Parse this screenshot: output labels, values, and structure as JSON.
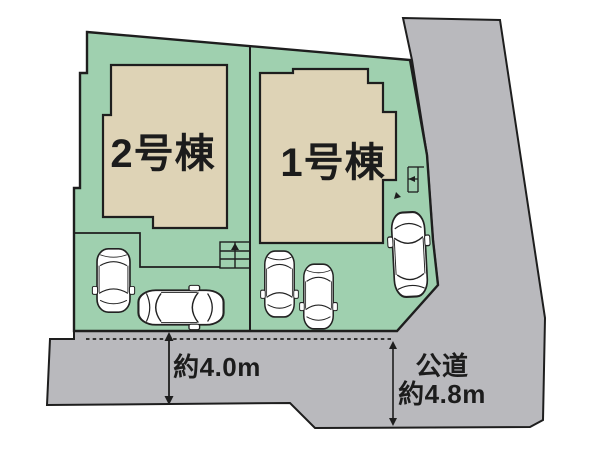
{
  "site_plan": {
    "type": "real-estate-lot-layout",
    "buildings": [
      {
        "label": "2号棟"
      },
      {
        "label": "1号棟"
      }
    ],
    "front_road": {
      "width_label": "約4.0m"
    },
    "side_road": {
      "type_label": "公道",
      "width_label": "約4.8m"
    },
    "car_count": 5,
    "colors": {
      "plot_green": "#9fd0af",
      "building_beige": "#ded3b6",
      "road_gray": "#b9b9bd",
      "outline_dark": "#1e1e1e",
      "car_white": "#ffffff",
      "text": "#1c1c1c",
      "background": "#ffffff"
    }
  }
}
